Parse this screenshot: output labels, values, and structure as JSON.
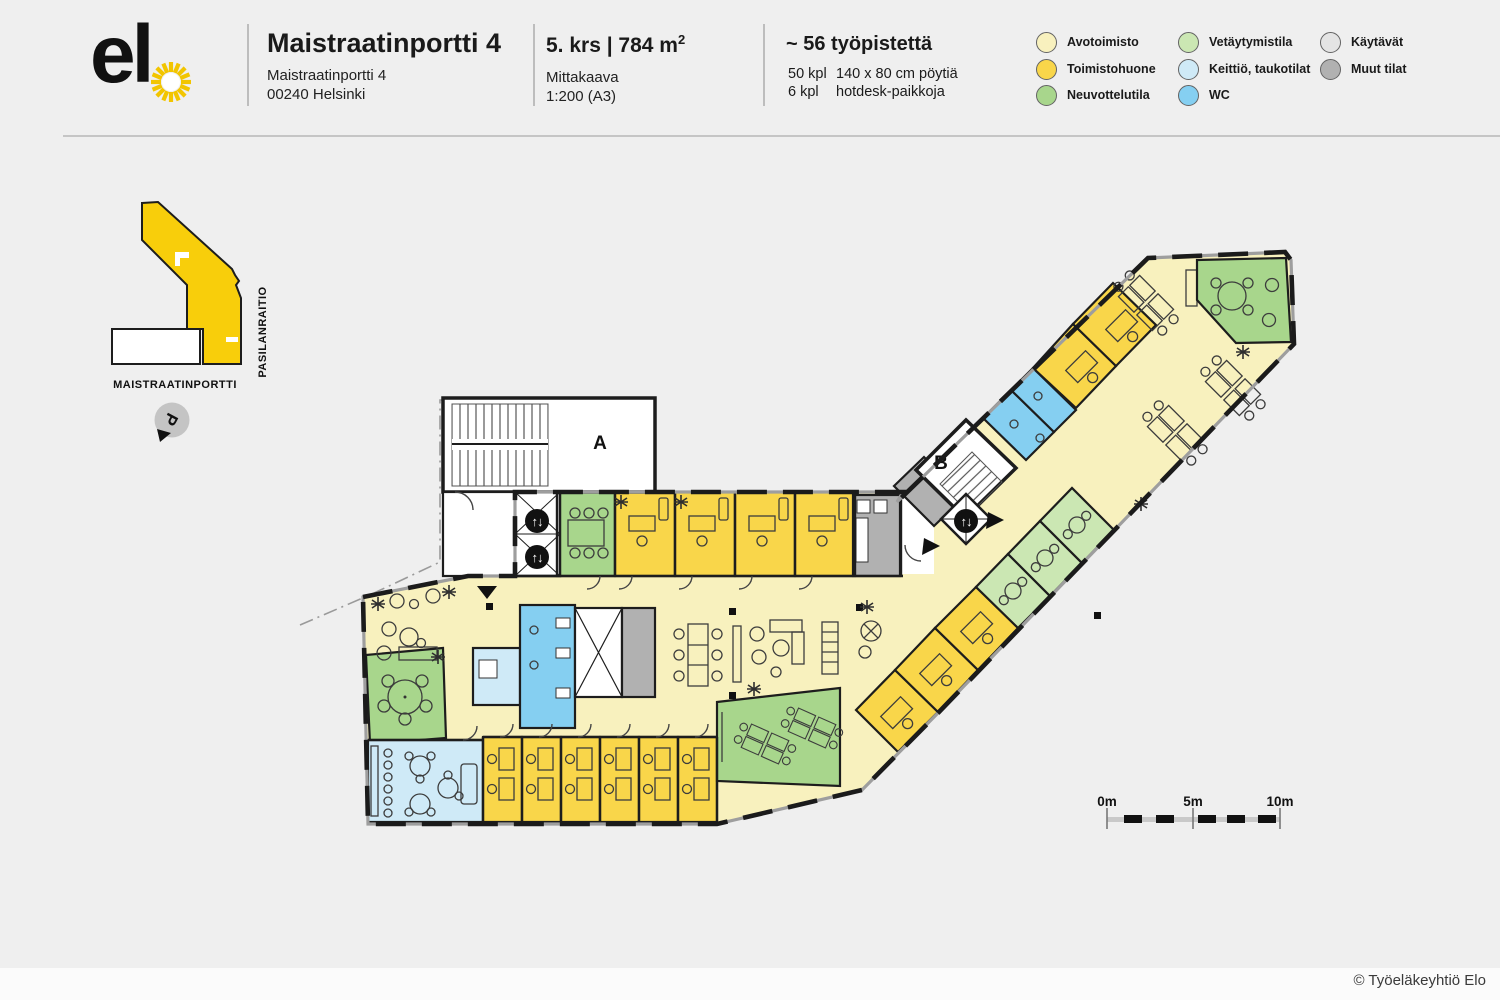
{
  "header": {
    "logo_text": "el",
    "title": "Maistraatinportti 4",
    "address_line1": "Maistraatinportti 4",
    "address_line2": "00240 Helsinki",
    "floor_area": "5. krs | 784 m",
    "floor_area_sup": "2",
    "scale_label": "Mittakaava",
    "scale_value": "1:200 (A3)",
    "workstations_title": "~ 56 työpistettä",
    "desk_count": "50 kpl",
    "desk_desc": "140 x 80 cm pöytiä",
    "hotdesk_count": "6 kpl",
    "hotdesk_desc": "hotdesk-paikkoja"
  },
  "legend": {
    "items": [
      {
        "label": "Avotoimisto",
        "color": "#F8F1BE"
      },
      {
        "label": "Toimistohuone",
        "color": "#F9D64A"
      },
      {
        "label": "Neuvottelutila",
        "color": "#A8D68C"
      },
      {
        "label": "Vetäytymistila",
        "color": "#CBE7B3"
      },
      {
        "label": "Keittiö, taukotilat",
        "color": "#CFEAF7"
      },
      {
        "label": "WC",
        "color": "#85CFF1"
      },
      {
        "label": "Käytävät",
        "color": "#E4E4E4"
      },
      {
        "label": "Muut tilat",
        "color": "#B1B1B1"
      }
    ]
  },
  "sitemap": {
    "street_bottom": "MAISTRAATINPORTTI",
    "street_right": "PASILANRAITIO",
    "parking_label": "P",
    "building_color": "#F8CE0B"
  },
  "plan": {
    "stair_a_label": "A",
    "stair_b_label": "B",
    "icon_elevator": "↑↓",
    "wall_color": "#1d1d1d"
  },
  "scalebar": {
    "zero": "0m",
    "five": "5m",
    "ten": "10m"
  },
  "footer": {
    "copyright": "© Työeläkeyhtiö Elo"
  }
}
